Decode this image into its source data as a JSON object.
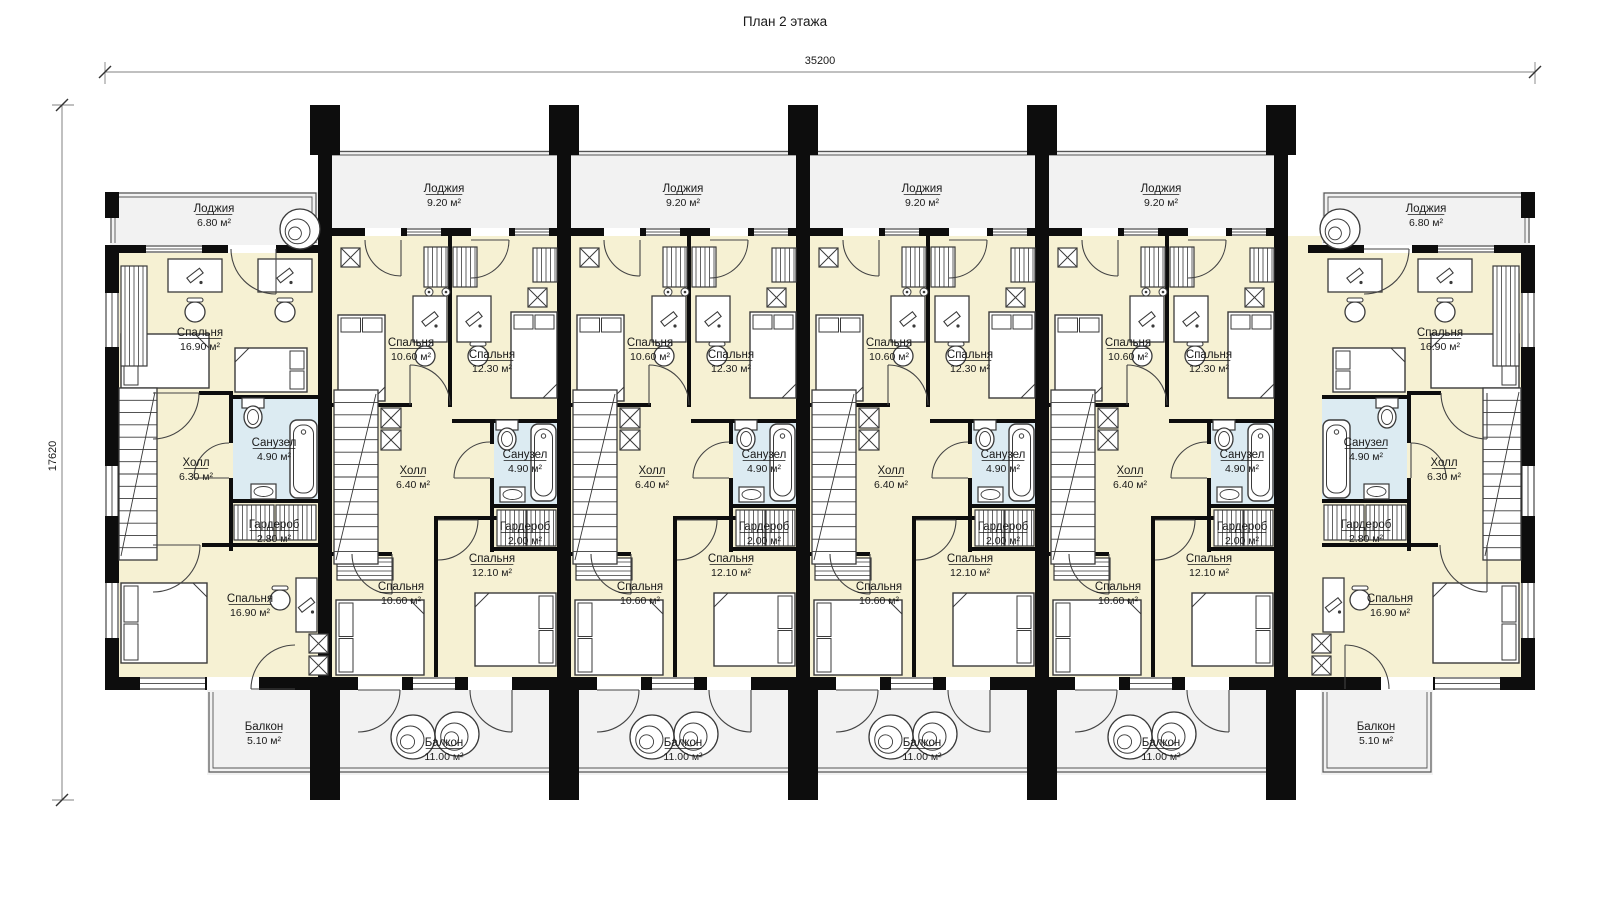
{
  "title": "План 2 этажа",
  "dims": {
    "width": "35200",
    "height": "17620"
  },
  "colors": {
    "wall": "#0d0d0d",
    "room": "#f6f1d3",
    "wet": "#dcebf2",
    "outdoor": "#f2f2f2",
    "furn_stroke": "#3a3a3a",
    "dim_line": "#808080",
    "text": "#1a1a1a"
  },
  "units": [
    {
      "id": "unit-1",
      "type": "end",
      "rooms": {
        "loggia": {
          "name": "Лоджия",
          "area": "6.80 м²"
        },
        "bedroom_top": {
          "name": "Спальня",
          "area": "16.90 м²"
        },
        "hall": {
          "name": "Холл",
          "area": "6.30 м²"
        },
        "bath": {
          "name": "Санузел",
          "area": "4.90 м²"
        },
        "ward": {
          "name": "Гардероб",
          "area": "2.80 м²"
        },
        "bedroom_bottom": {
          "name": "Спальня",
          "area": "16.90 м²"
        },
        "balcony": {
          "name": "Балкон",
          "area": "5.10 м²"
        }
      }
    },
    {
      "id": "unit-2",
      "type": "mid",
      "rooms": {
        "loggia": {
          "name": "Лоджия",
          "area": "9.20 м²"
        },
        "bedroom_tl": {
          "name": "Спальня",
          "area": "10.60 м²"
        },
        "bedroom_tr": {
          "name": "Спальня",
          "area": "12.30 м²"
        },
        "hall": {
          "name": "Холл",
          "area": "6.40 м²"
        },
        "bath": {
          "name": "Санузел",
          "area": "4.90 м²"
        },
        "ward": {
          "name": "Гардероб",
          "area": "2.00 м²"
        },
        "bedroom_bl": {
          "name": "Спальня",
          "area": "10.60 м²"
        },
        "bedroom_br": {
          "name": "Спальня",
          "area": "12.10 м²"
        },
        "balcony": {
          "name": "Балкон",
          "area": "11.00 м²"
        }
      }
    },
    {
      "id": "unit-3",
      "type": "mid",
      "rooms": {
        "loggia": {
          "name": "Лоджия",
          "area": "9.20 м²"
        },
        "bedroom_tl": {
          "name": "Спальня",
          "area": "10.60 м²"
        },
        "bedroom_tr": {
          "name": "Спальня",
          "area": "12.30 м²"
        },
        "hall": {
          "name": "Холл",
          "area": "6.40 м²"
        },
        "bath": {
          "name": "Санузел",
          "area": "4.90 м²"
        },
        "ward": {
          "name": "Гардероб",
          "area": "2.00 м²"
        },
        "bedroom_bl": {
          "name": "Спальня",
          "area": "10.60 м²"
        },
        "bedroom_br": {
          "name": "Спальня",
          "area": "12.10 м²"
        },
        "balcony": {
          "name": "Балкон",
          "area": "11.00 м²"
        }
      }
    },
    {
      "id": "unit-4",
      "type": "mid",
      "rooms": {
        "loggia": {
          "name": "Лоджия",
          "area": "9.20 м²"
        },
        "bedroom_tl": {
          "name": "Спальня",
          "area": "10.60 м²"
        },
        "bedroom_tr": {
          "name": "Спальня",
          "area": "12.30 м²"
        },
        "hall": {
          "name": "Холл",
          "area": "6.40 м²"
        },
        "bath": {
          "name": "Санузел",
          "area": "4.90 м²"
        },
        "ward": {
          "name": "Гардероб",
          "area": "2.00 м²"
        },
        "bedroom_bl": {
          "name": "Спальня",
          "area": "10.60 м²"
        },
        "bedroom_br": {
          "name": "Спальня",
          "area": "12.10 м²"
        },
        "balcony": {
          "name": "Балкон",
          "area": "11.00 м²"
        }
      }
    },
    {
      "id": "unit-5",
      "type": "mid",
      "rooms": {
        "loggia": {
          "name": "Лоджия",
          "area": "9.20 м²"
        },
        "bedroom_tl": {
          "name": "Спальня",
          "area": "10.60 м²"
        },
        "bedroom_tr": {
          "name": "Спальня",
          "area": "12.30 м²"
        },
        "hall": {
          "name": "Холл",
          "area": "6.40 м²"
        },
        "bath": {
          "name": "Санузел",
          "area": "4.90 м²"
        },
        "ward": {
          "name": "Гардероб",
          "area": "2.00 м²"
        },
        "bedroom_bl": {
          "name": "Спальня",
          "area": "10.60 м²"
        },
        "bedroom_br": {
          "name": "Спальня",
          "area": "12.10 м²"
        },
        "balcony": {
          "name": "Балкон",
          "area": "11.00 м²"
        }
      }
    },
    {
      "id": "unit-6",
      "type": "end",
      "rooms": {
        "loggia": {
          "name": "Лоджия",
          "area": "6.80 м²"
        },
        "bedroom_top": {
          "name": "Спальня",
          "area": "16.90 м²"
        },
        "hall": {
          "name": "Холл",
          "area": "6.30 м²"
        },
        "bath": {
          "name": "Санузел",
          "area": "4.90 м²"
        },
        "ward": {
          "name": "Гардероб",
          "area": "2.80 м²"
        },
        "bedroom_bottom": {
          "name": "Спальня",
          "area": "16.90 м²"
        },
        "balcony": {
          "name": "Балкон",
          "area": "5.10 м²"
        }
      }
    }
  ]
}
